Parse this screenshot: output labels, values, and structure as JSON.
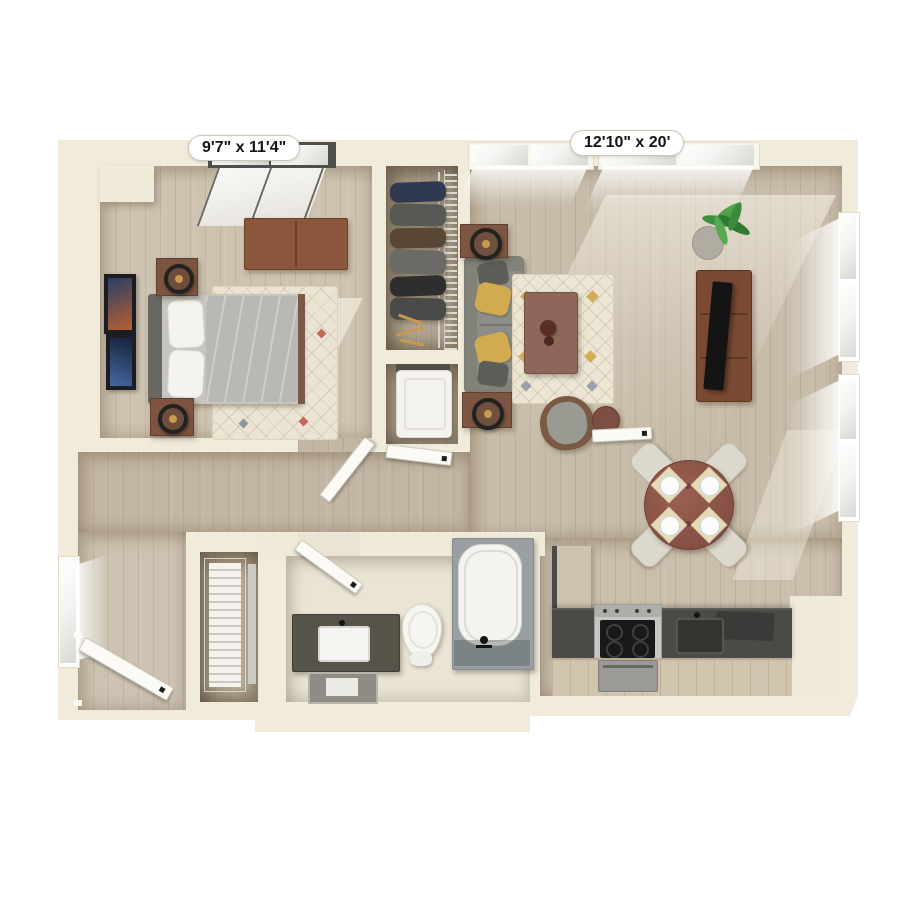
{
  "floorplan": {
    "type": "3d-top-down-apartment-floor-plan",
    "labels": {
      "bedroom_dimensions": "9'7\" x 11'4\"",
      "living_room_dimensions": "12'10\" x 20'"
    },
    "rooms": [
      {
        "name": "bedroom",
        "dimensions": "9'7\" x 11'4\"",
        "furniture": [
          "window",
          "dresser",
          "bed",
          "headboard",
          "pillows",
          "duvet",
          "nightstand-upper",
          "nightstand-lower",
          "table-lamps",
          "area-rug",
          "wall-art-1",
          "wall-art-2",
          "door-open"
        ]
      },
      {
        "name": "wardrobe-closet",
        "furniture": [
          "hanging-clothes",
          "closet-rod",
          "wire-shelf",
          "hangers"
        ]
      },
      {
        "name": "laundry-closet",
        "furniture": [
          "washer-unit",
          "closet-door"
        ]
      },
      {
        "name": "living-room",
        "dimensions": "12'10\" x 20'",
        "furniture": [
          "clerestory-windows",
          "side-windows",
          "sofa",
          "throw-pillows",
          "end-table-upper",
          "end-table-lower",
          "lamps",
          "area-rug",
          "coffee-table",
          "decor-vase",
          "armchair",
          "round-side-table",
          "tv-console",
          "flat-screen-tv",
          "potted-plant"
        ]
      },
      {
        "name": "dining-area",
        "furniture": [
          "round-dining-table",
          "dining-chairs-x4",
          "placemats-x4",
          "plates-x4"
        ]
      },
      {
        "name": "kitchen",
        "furniture": [
          "l-counter",
          "range-stove",
          "oven",
          "sink",
          "faucet",
          "base-cabinets",
          "counter-appliance"
        ]
      },
      {
        "name": "bathroom",
        "furniture": [
          "vanity",
          "vessel-sink",
          "mirror",
          "toilet",
          "bathtub",
          "tub-faucet",
          "door-open"
        ]
      },
      {
        "name": "entry",
        "furniture": [
          "front-door-open",
          "side-window"
        ]
      },
      {
        "name": "entry-closet",
        "furniture": [
          "louvered-doors"
        ]
      },
      {
        "name": "hallway",
        "furniture": []
      }
    ],
    "colors": {
      "background": "#ffffff",
      "wall_cream": "#f1ebdc",
      "wood_floor": "#c6baa9",
      "rug_cream": "#ece5d3",
      "sofa_gray": "#8e8e88",
      "accent_pillow_yellow": "#d2ab50",
      "wood_furniture_brown": "#8a573c",
      "dining_table_brown": "#8a5348",
      "counter_dark_gray": "#4c4a47",
      "tv_black": "#141414",
      "plant_green": "#3f9140",
      "fixture_white": "#f5f4f0",
      "label_text": "#141414"
    },
    "window_counts": {
      "bedroom_top": 2,
      "living_top": 4,
      "living_right": 4,
      "entry_left": 1
    }
  }
}
